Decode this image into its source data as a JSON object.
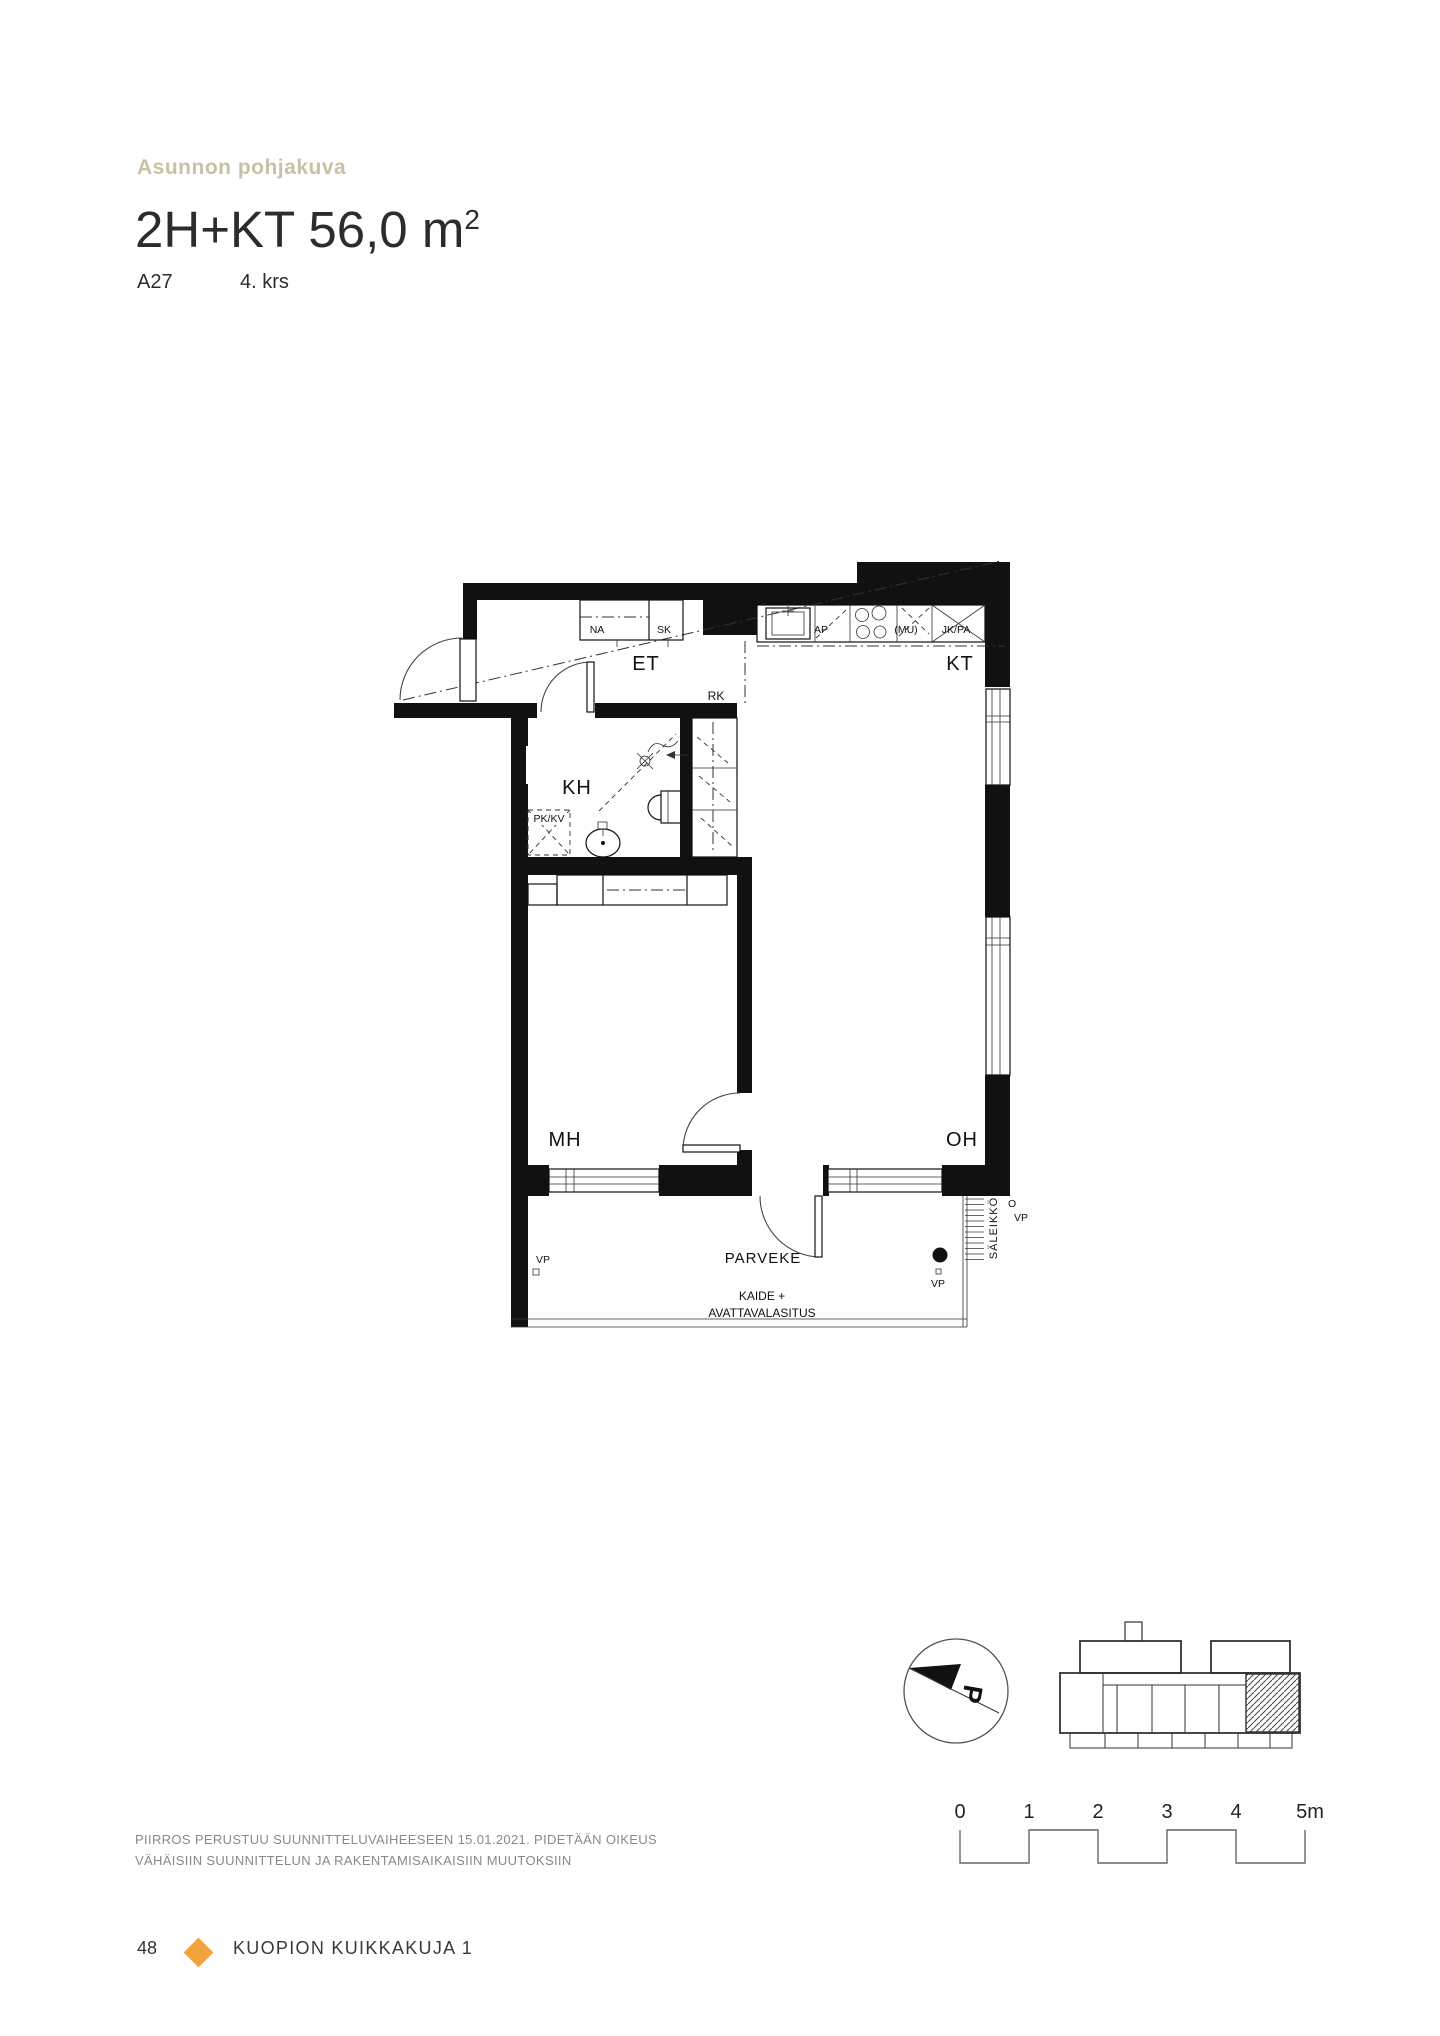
{
  "page": {
    "eyebrow": "Asunnon pohjakuva",
    "title": "2H+KT 56,0 m",
    "title_superscript": "2",
    "apartment_id": "A27",
    "floor": "4. krs"
  },
  "floorplan": {
    "room_labels": {
      "et": "ET",
      "kt": "KT",
      "kh": "KH",
      "mh": "MH",
      "oh": "OH",
      "parveke": "PARVEKE"
    },
    "fixture_labels": {
      "na": "NA",
      "sk": "SK",
      "ap": "AP",
      "mu": "(MU)",
      "jkpa": "JK/PA",
      "rk": "RK",
      "pkkv": "PK/KV",
      "vp": "VP",
      "o": "O",
      "saleikko": "SÄLEIKKÖ",
      "kaide_line1": "KAIDE +",
      "kaide_line2": "AVATTAVALASITUS"
    },
    "compass_label": "P"
  },
  "scalebar": {
    "labels": [
      "0",
      "1",
      "2",
      "3",
      "4",
      "5m"
    ]
  },
  "disclaimer": {
    "line1": "PIIRROS PERUSTUU SUUNNITTELUVAIHEESEEN 15.01.2021. PIDETÄÄN OIKEUS",
    "line2": "VÄHÄISIIN SUUNNITTELUN JA RAKENTAMISAIKAISIIN MUUTOKSIIN"
  },
  "footer": {
    "page_number": "48",
    "project_name": "KUOPION KUIKKAKUJA 1"
  },
  "colors": {
    "eyebrow": "#C9C0A8",
    "accent_diamond": "#F2A43C",
    "heading": "#2A2C30",
    "muted_text": "#87898D",
    "plan_ink": "#111111"
  }
}
